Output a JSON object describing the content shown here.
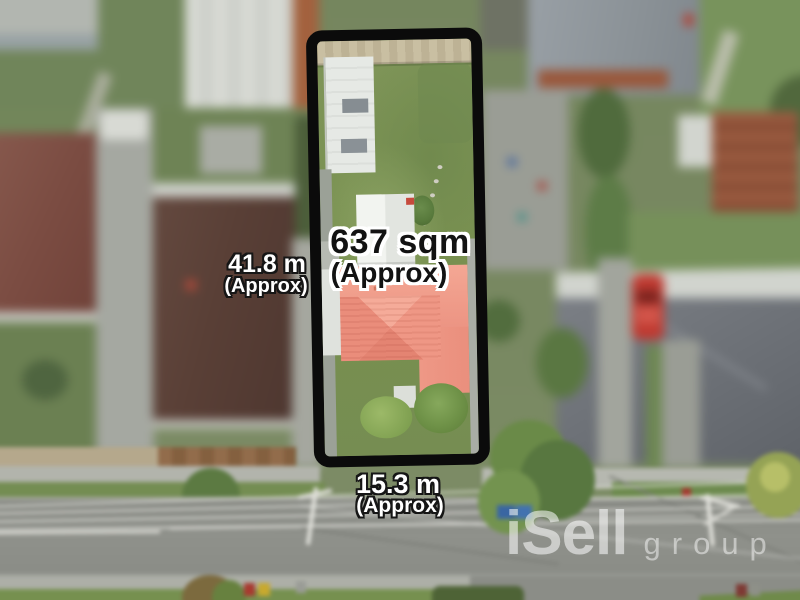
{
  "meta": {
    "image_type": "aerial-property-marketing-photo"
  },
  "labels": {
    "area": {
      "value": "637 sqm",
      "qualifier": "(Approx)"
    },
    "depth": {
      "value": "41.8 m",
      "qualifier": "(Approx)"
    },
    "frontage": {
      "value": "15.3 m",
      "qualifier": "(Approx)"
    }
  },
  "watermark": {
    "brand": "iSell",
    "suffix": "group"
  },
  "colors": {
    "boundary_outline": "#0b0b0b",
    "area_text": "#121212",
    "area_text_outline": "#ffffff",
    "dimension_text": "#ffffff",
    "dimension_text_outline": "#161616",
    "subject_roof": "#ee9583",
    "subject_lawn": "#7d9358",
    "road": "#8e908a",
    "watermark_white": "#ffffff"
  }
}
